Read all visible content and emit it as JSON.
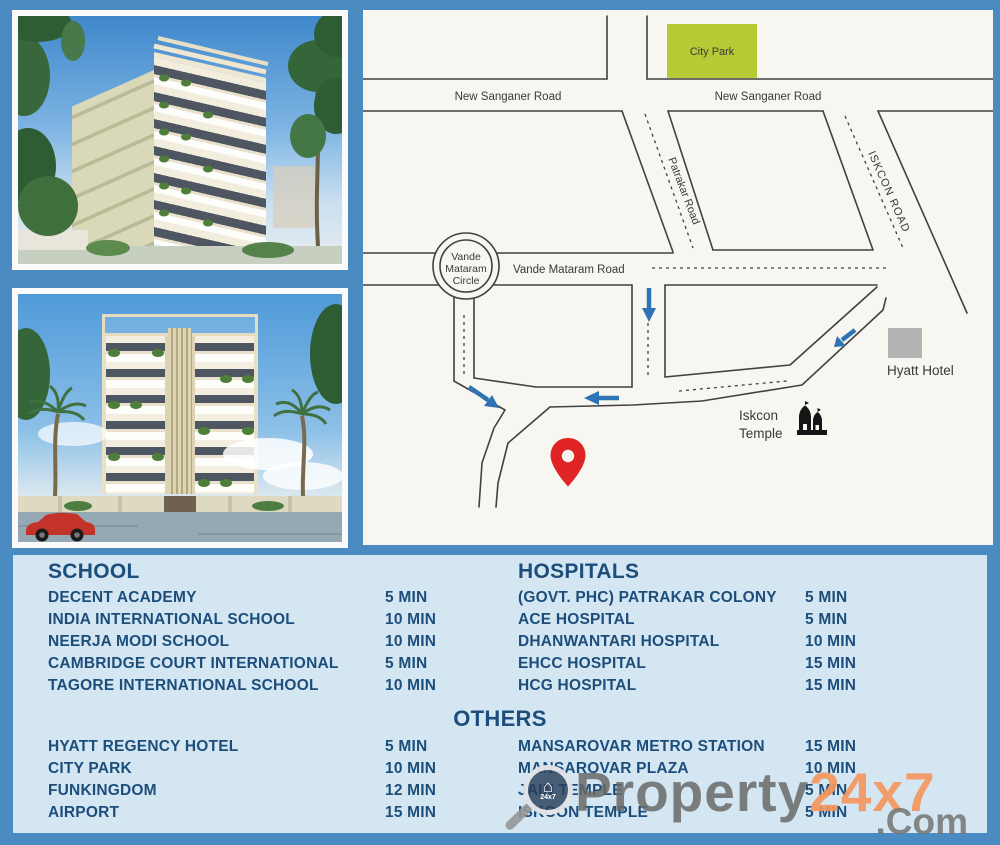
{
  "colors": {
    "background_blue": "#4a8bc2",
    "panel_blue": "#d3e6f2",
    "text_navy": "#1d4e7b",
    "park_green": "#b5ca35",
    "pin_red": "#e02424",
    "arrow_blue": "#2e74b4",
    "hotel_gray": "#b3b3b3",
    "watermark_orange": "#f3965d",
    "watermark_gray": "#696969"
  },
  "map": {
    "park_label": "City Park",
    "road_new_sanganer_left": "New Sanganer Road",
    "road_new_sanganer_right": "New Sanganer Road",
    "road_patrakar": "Patrakar Road",
    "road_iskcon": "ISKCON ROAD",
    "road_vande_mataram": "Vande Mataram Road",
    "circle_line1": "Vande",
    "circle_line2": "Mataram",
    "circle_line3": "Circle",
    "hyatt_label": "Hyatt Hotel",
    "temple_label_line1": "Iskcon",
    "temple_label_line2": "Temple"
  },
  "lists": {
    "school": {
      "title": "SCHOOL",
      "items": [
        {
          "name": "DECENT ACADEMY",
          "time": "5 MIN"
        },
        {
          "name": "INDIA INTERNATIONAL SCHOOL",
          "time": "10 MIN"
        },
        {
          "name": "NEERJA MODI SCHOOL",
          "time": "10 MIN"
        },
        {
          "name": "CAMBRIDGE COURT INTERNATIONAL",
          "time": "5 MIN"
        },
        {
          "name": "TAGORE INTERNATIONAL SCHOOL",
          "time": "10 MIN"
        }
      ]
    },
    "hospitals": {
      "title": "HOSPITALS",
      "items": [
        {
          "name": "(GOVT. PHC) PATRAKAR COLONY",
          "time": "5 MIN"
        },
        {
          "name": "ACE HOSPITAL",
          "time": "5 MIN"
        },
        {
          "name": "DHANWANTARI HOSPITAL",
          "time": "10 MIN"
        },
        {
          "name": "EHCC HOSPITAL",
          "time": "15 MIN"
        },
        {
          "name": "HCG HOSPITAL",
          "time": "15 MIN"
        }
      ]
    },
    "others": {
      "title": "OTHERS",
      "left": [
        {
          "name": "HYATT REGENCY HOTEL",
          "time": "5 MIN"
        },
        {
          "name": "CITY PARK",
          "time": "10 MIN"
        },
        {
          "name": "FUNKINGDOM",
          "time": "12 MIN"
        },
        {
          "name": "AIRPORT",
          "time": "15 MIN"
        }
      ],
      "right": [
        {
          "name": "MANSAROVAR METRO STATION",
          "time": "15 MIN"
        },
        {
          "name": "MANSAROVAR PLAZA",
          "time": "10 MIN"
        },
        {
          "name": "JAIN TEMPLE",
          "time": "5 MIN"
        },
        {
          "name": "ISKCON TEMPLE",
          "time": "5 MIN"
        }
      ]
    }
  },
  "watermark": {
    "brand_gray": "Property",
    "brand_orange": "24x7",
    "suffix": ".Com",
    "logo_text": "24x7",
    "logo_house_glyph": "⌂"
  }
}
